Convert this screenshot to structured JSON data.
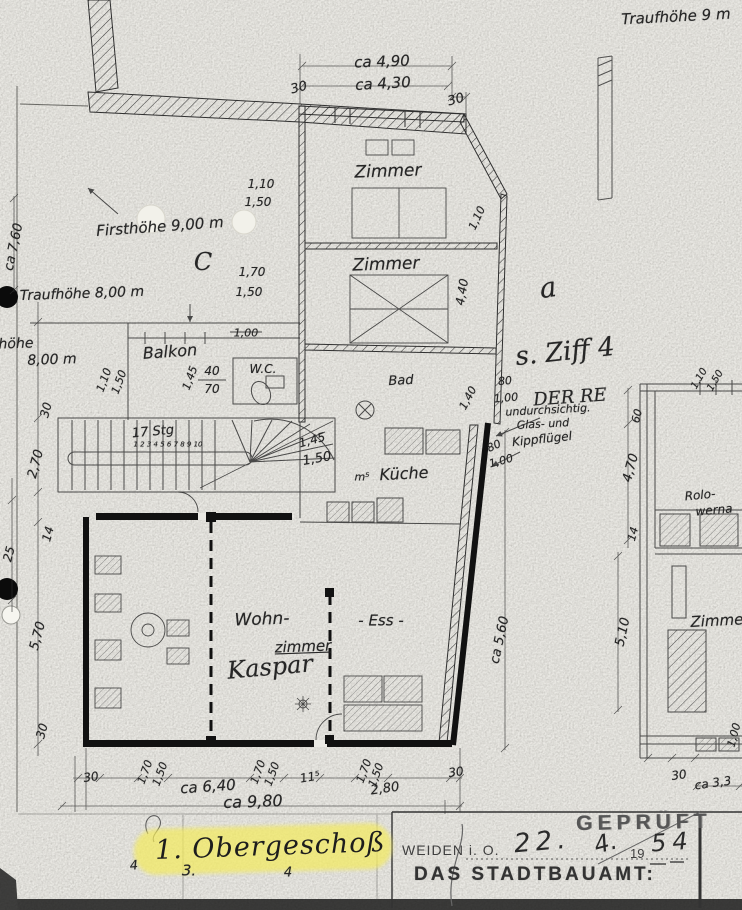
{
  "title": {
    "floor_label": "1. Obergeschoß"
  },
  "stamp": {
    "gepruft": "GEPRÜFT",
    "city": "WEIDEN i. O.",
    "date_day": "22.",
    "date_month": "4.",
    "year_printed": "19",
    "year_hand": "54",
    "office": "DAS STADTBAUAMT:"
  },
  "colors": {
    "paper": "#eae9e4",
    "ink": "#2e2e2e",
    "highlight_yellow": "#f3ea5f",
    "stamp_gray": "#565656",
    "hole_punch_black": "#0b0b0b"
  },
  "annotations": [
    {
      "name": "note-traufhoehe-9m",
      "text": "Traufhöhe 9 m",
      "x": 676,
      "y": 17,
      "rot": -3,
      "size": 15
    },
    {
      "name": "dim-label",
      "text": "ca 4,90",
      "x": 382,
      "y": 62,
      "rot": -2,
      "size": 15
    },
    {
      "name": "dim-label",
      "text": "ca 4,30",
      "x": 383,
      "y": 84,
      "rot": -3,
      "size": 15
    },
    {
      "name": "dim-label",
      "text": "30",
      "x": 299,
      "y": 88,
      "rot": -15,
      "size": 13
    },
    {
      "name": "dim-label",
      "text": "30",
      "x": 456,
      "y": 100,
      "rot": -15,
      "size": 13
    },
    {
      "name": "room-zimmer-1",
      "text": "Zimmer",
      "x": 388,
      "y": 172,
      "rot": -2,
      "size": 17
    },
    {
      "name": "dim-label",
      "text": "1,10",
      "x": 261,
      "y": 184,
      "rot": 0,
      "size": 12
    },
    {
      "name": "dim-label",
      "text": "1,50",
      "x": 258,
      "y": 202,
      "rot": 0,
      "size": 12
    },
    {
      "name": "note-firsthoehe",
      "text": "Firsthöhe 9,00 m",
      "x": 160,
      "y": 227,
      "rot": -4,
      "size": 15
    },
    {
      "name": "mark-c",
      "text": "C",
      "x": 203,
      "y": 262,
      "rot": 0,
      "size": 24,
      "cls": "hw-big"
    },
    {
      "name": "room-zimmer-2",
      "text": "Zimmer",
      "x": 386,
      "y": 265,
      "rot": -2,
      "size": 17
    },
    {
      "name": "dim-label",
      "text": "1,70",
      "x": 252,
      "y": 272,
      "rot": 0,
      "size": 12
    },
    {
      "name": "dim-label",
      "text": "1,50",
      "x": 249,
      "y": 292,
      "rot": 0,
      "size": 12
    },
    {
      "name": "note-traufhoehe-8a",
      "text": "Traufhöhe 8,00 m",
      "x": 82,
      "y": 294,
      "rot": -2,
      "size": 14
    },
    {
      "name": "dim-label",
      "text": "1,10",
      "x": 477,
      "y": 218,
      "rot": -65,
      "size": 11
    },
    {
      "name": "dim-label",
      "text": "4,40",
      "x": 462,
      "y": 292,
      "rot": -80,
      "size": 12
    },
    {
      "name": "mark-a",
      "text": "a",
      "x": 548,
      "y": 288,
      "rot": -8,
      "size": 28,
      "cls": "hw-big"
    },
    {
      "name": "note-traufhoehe-8b-1",
      "text": "höhe",
      "x": 16,
      "y": 344,
      "rot": -2,
      "size": 14
    },
    {
      "name": "note-traufhoehe-8b-2",
      "text": "8,00 m",
      "x": 52,
      "y": 360,
      "rot": -2,
      "size": 14
    },
    {
      "name": "room-balkon",
      "text": "Balkon",
      "x": 170,
      "y": 352,
      "rot": -4,
      "size": 16
    },
    {
      "name": "dim-label",
      "text": "1,10",
      "x": 104,
      "y": 380,
      "rot": -70,
      "size": 11
    },
    {
      "name": "dim-label",
      "text": "1,50",
      "x": 119,
      "y": 382,
      "rot": -70,
      "size": 11
    },
    {
      "name": "dim-label",
      "text": "1,00",
      "x": 246,
      "y": 333,
      "rot": 0,
      "size": 11
    },
    {
      "name": "dim-label",
      "text": "1,45",
      "x": 190,
      "y": 378,
      "rot": -70,
      "size": 11
    },
    {
      "name": "dim-label",
      "text": "40",
      "x": 212,
      "y": 371,
      "rot": 0,
      "size": 12
    },
    {
      "name": "dim-label",
      "text": "70",
      "x": 212,
      "y": 389,
      "rot": 0,
      "size": 12
    },
    {
      "name": "room-wc",
      "text": "W.C.",
      "x": 263,
      "y": 369,
      "rot": 0,
      "size": 12
    },
    {
      "name": "note-ziff",
      "text": "s. Ziff 4",
      "x": 565,
      "y": 352,
      "rot": -6,
      "size": 26,
      "cls": "hw-big"
    },
    {
      "name": "note-der-re",
      "text": "DER RE",
      "x": 570,
      "y": 398,
      "rot": -4,
      "size": 18,
      "cls": "hw-big"
    },
    {
      "name": "dim-label",
      "text": "80",
      "x": 505,
      "y": 381,
      "rot": -5,
      "size": 11
    },
    {
      "name": "dim-label",
      "text": "1,00",
      "x": 506,
      "y": 398,
      "rot": -5,
      "size": 11
    },
    {
      "name": "note-glas-1",
      "text": "undurchsichtig.",
      "x": 548,
      "y": 410,
      "rot": -3,
      "size": 11
    },
    {
      "name": "note-glas-2",
      "text": "Glas- und",
      "x": 543,
      "y": 424,
      "rot": -3,
      "size": 11
    },
    {
      "name": "note-glas-3",
      "text": "Kippflügel",
      "x": 542,
      "y": 439,
      "rot": -6,
      "size": 12
    },
    {
      "name": "dim-label",
      "text": "60",
      "x": 637,
      "y": 416,
      "rot": -75,
      "size": 11
    },
    {
      "name": "room-bad",
      "text": "Bad",
      "x": 401,
      "y": 381,
      "rot": -3,
      "size": 13
    },
    {
      "name": "dim-label",
      "text": "1,40",
      "x": 468,
      "y": 398,
      "rot": -62,
      "size": 11
    },
    {
      "name": "dim-label",
      "text": "80",
      "x": 494,
      "y": 446,
      "rot": -25,
      "size": 11
    },
    {
      "name": "dim-label",
      "text": "1,00",
      "x": 501,
      "y": 461,
      "rot": -15,
      "size": 11
    },
    {
      "name": "dim-label",
      "text": "m⁵",
      "x": 362,
      "y": 477,
      "rot": 0,
      "size": 11
    },
    {
      "name": "room-kueche",
      "text": "Küche",
      "x": 404,
      "y": 474,
      "rot": -3,
      "size": 16
    },
    {
      "name": "note-stairs",
      "text": "17 Stg",
      "x": 153,
      "y": 432,
      "rot": -5,
      "size": 13
    },
    {
      "name": "note-stair-numbers",
      "text": "1 2 3 4 5 6 7 8 9 10",
      "x": 168,
      "y": 445,
      "rot": 0,
      "size": 7
    },
    {
      "name": "dim-label",
      "text": "1,45",
      "x": 312,
      "y": 440,
      "rot": -15,
      "size": 12
    },
    {
      "name": "dim-label",
      "text": "1,50",
      "x": 317,
      "y": 459,
      "rot": -10,
      "size": 13
    },
    {
      "name": "dim-label",
      "text": "ca 7,60",
      "x": 14,
      "y": 247,
      "rot": -78,
      "size": 13
    },
    {
      "name": "dim-label",
      "text": "30",
      "x": 46,
      "y": 410,
      "rot": -75,
      "size": 12
    },
    {
      "name": "dim-label",
      "text": "2,70",
      "x": 36,
      "y": 464,
      "rot": -75,
      "size": 13
    },
    {
      "name": "dim-label",
      "text": "25",
      "x": 9,
      "y": 554,
      "rot": -75,
      "size": 12
    },
    {
      "name": "dim-label",
      "text": "14",
      "x": 48,
      "y": 534,
      "rot": -75,
      "size": 12
    },
    {
      "name": "dim-label",
      "text": "5,70",
      "x": 38,
      "y": 636,
      "rot": -75,
      "size": 13
    },
    {
      "name": "dim-label",
      "text": "30",
      "x": 42,
      "y": 731,
      "rot": -75,
      "size": 12
    },
    {
      "name": "room-wohn",
      "text": "Wohn-",
      "x": 262,
      "y": 620,
      "rot": -2,
      "size": 17
    },
    {
      "name": "room-zimmer-label",
      "text": "zimmer",
      "x": 303,
      "y": 647,
      "rot": -2,
      "size": 15,
      "cls": "u"
    },
    {
      "name": "room-ess",
      "text": "- Ess -",
      "x": 381,
      "y": 621,
      "rot": 0,
      "size": 15
    },
    {
      "name": "note-kaspar",
      "text": "Kaspar",
      "x": 270,
      "y": 667,
      "rot": -5,
      "size": 24,
      "cls": "hw-big"
    },
    {
      "name": "dim-label",
      "text": "ca 5,60",
      "x": 500,
      "y": 640,
      "rot": -78,
      "size": 13
    },
    {
      "name": "dim-label",
      "text": "5,10",
      "x": 623,
      "y": 632,
      "rot": -78,
      "size": 13
    },
    {
      "name": "note-rolo-1",
      "text": "Rolo-",
      "x": 700,
      "y": 495,
      "rot": -5,
      "size": 12
    },
    {
      "name": "note-rolo-2",
      "text": "werna",
      "x": 714,
      "y": 510,
      "rot": -5,
      "size": 12
    },
    {
      "name": "room-zimmer-right",
      "text": "Zimmer",
      "x": 720,
      "y": 621,
      "rot": -3,
      "size": 15
    },
    {
      "name": "dim-label",
      "text": "1,10",
      "x": 700,
      "y": 379,
      "rot": -60,
      "size": 10
    },
    {
      "name": "dim-label",
      "text": "1,50",
      "x": 716,
      "y": 381,
      "rot": -60,
      "size": 10
    },
    {
      "name": "dim-label",
      "text": "4,70",
      "x": 631,
      "y": 468,
      "rot": -75,
      "size": 13
    },
    {
      "name": "dim-label",
      "text": "14",
      "x": 633,
      "y": 534,
      "rot": -75,
      "size": 11
    },
    {
      "name": "dim-label",
      "text": "1,00",
      "x": 734,
      "y": 735,
      "rot": -75,
      "size": 11
    },
    {
      "name": "dim-label",
      "text": "30",
      "x": 679,
      "y": 775,
      "rot": -8,
      "size": 12
    },
    {
      "name": "dim-label",
      "text": "ca 3,3",
      "x": 713,
      "y": 783,
      "rot": -8,
      "size": 12
    },
    {
      "name": "dim-label",
      "text": "30",
      "x": 91,
      "y": 777,
      "rot": -8,
      "size": 12
    },
    {
      "name": "dim-label",
      "text": "1,70",
      "x": 145,
      "y": 772,
      "rot": -70,
      "size": 11
    },
    {
      "name": "dim-label",
      "text": "1,50",
      "x": 160,
      "y": 774,
      "rot": -70,
      "size": 11
    },
    {
      "name": "dim-label",
      "text": "ca 6,40",
      "x": 208,
      "y": 787,
      "rot": -4,
      "size": 15
    },
    {
      "name": "dim-label",
      "text": "1,70",
      "x": 258,
      "y": 772,
      "rot": -70,
      "size": 11
    },
    {
      "name": "dim-label",
      "text": "1,50",
      "x": 272,
      "y": 774,
      "rot": -70,
      "size": 11
    },
    {
      "name": "dim-label",
      "text": "11⁵",
      "x": 310,
      "y": 777,
      "rot": -10,
      "size": 12
    },
    {
      "name": "dim-label",
      "text": "1,70",
      "x": 364,
      "y": 771,
      "rot": -70,
      "size": 11
    },
    {
      "name": "dim-label",
      "text": "1,50",
      "x": 376,
      "y": 775,
      "rot": -70,
      "size": 11
    },
    {
      "name": "dim-label",
      "text": "2,80",
      "x": 385,
      "y": 789,
      "rot": -8,
      "size": 13
    },
    {
      "name": "dim-label",
      "text": "30",
      "x": 456,
      "y": 772,
      "rot": -8,
      "size": 12
    },
    {
      "name": "dim-label",
      "text": "ca 9,80",
      "x": 253,
      "y": 802,
      "rot": -2,
      "size": 16
    },
    {
      "name": "mark-4a",
      "text": "4",
      "x": 134,
      "y": 866,
      "rot": -5,
      "size": 13
    },
    {
      "name": "mark-3",
      "text": "3.",
      "x": 189,
      "y": 871,
      "rot": 0,
      "size": 15
    },
    {
      "name": "mark-4b",
      "text": "4",
      "x": 288,
      "y": 873,
      "rot": 0,
      "size": 13
    }
  ]
}
